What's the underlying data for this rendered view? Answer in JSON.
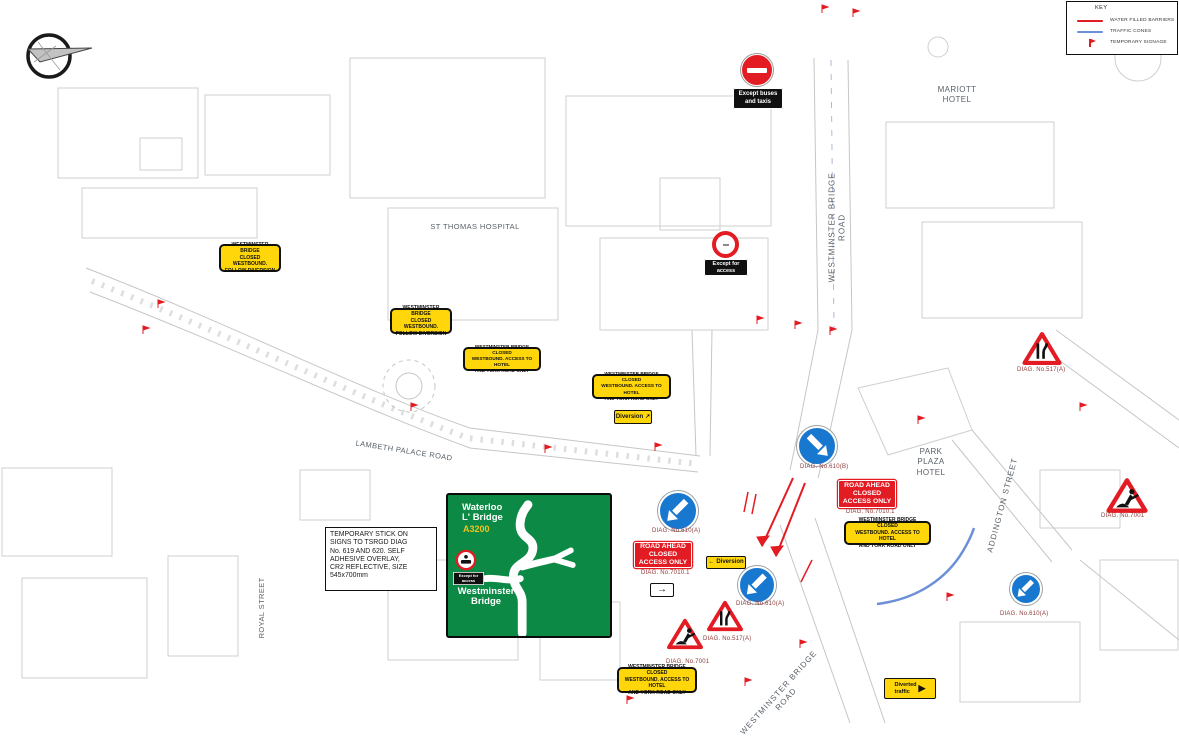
{
  "legend": {
    "title": "KEY",
    "items": [
      {
        "name": "water-filled-barriers",
        "label": "WATER FILLED BARRIERS",
        "color": "#e31b23",
        "swatch": "red-line"
      },
      {
        "name": "traffic-cones",
        "label": "TRAFFIC CONES",
        "color": "#6b8fd8",
        "swatch": "blue-line"
      },
      {
        "name": "temporary-signage",
        "label": "TEMPORARY SIGNAGE",
        "color": "#e31b23",
        "swatch": "red-flag"
      }
    ]
  },
  "street_labels": {
    "st_thomas_hospital": "ST THOMAS HOSPITAL",
    "mariott_hotel": "MARIOTT\nHOTEL",
    "westminster_bridge_road_top": "WESTMINSTER BRIDGE ROAD",
    "lambeth_palace_road": "LAMBETH PALACE ROAD",
    "royal_street": "ROYAL STREET",
    "park_plaza_hotel": "PARK\nPLAZA\nHOTEL",
    "addington_street": "ADDINGTON STREET",
    "westminster_bridge_road_bottom": "WESTMINSTER BRIDGE ROAD"
  },
  "temp_signs": {
    "closed_follow_diversion": "WESTMINSTER BRIDGE\nCLOSED WESTBOUND.\nFOLLOW DIVERSION",
    "closed_access_only": "WESTMINSTER BRIDGE CLOSED\nWESTBOUND. ACCESS TO HOTEL\nAND YORK ROAD ONLY",
    "road_ahead_closed": "ROAD AHEAD\nCLOSED\nACCESS ONLY",
    "diversion": "Diversion",
    "diverted_traffic": "Diverted\ntraffic"
  },
  "plates": {
    "except_buses": "Except buses\nand taxis",
    "except_access": "Except for\naccess"
  },
  "diag_refs": {
    "d610a": "DIAG. No.610(A)",
    "d610b": "DIAG. No.610(B)",
    "d7010": "DIAG. No.7010.1",
    "d517a": "DIAG. No.517(A)",
    "d7001": "DIAG. No.7001"
  },
  "green_sign": {
    "destination_top": "Waterloo\nL' Bridge",
    "route_number": "A3200",
    "plate": "Except for\naccess",
    "destination_bottom": "Westminster\nBridge"
  },
  "note": "TEMPORARY STICK ON\nSIGNS TO TSRGD DIAG\nNo. 619 AND 620. SELF\nADHESIVE OVERLAY,\nCR2 REFLECTIVE, SIZE\n545x700mm",
  "glyphs": {
    "arrow_ne": "↗",
    "arrow_left": "←",
    "arrow_right": "→",
    "chevron_right": "▶"
  }
}
